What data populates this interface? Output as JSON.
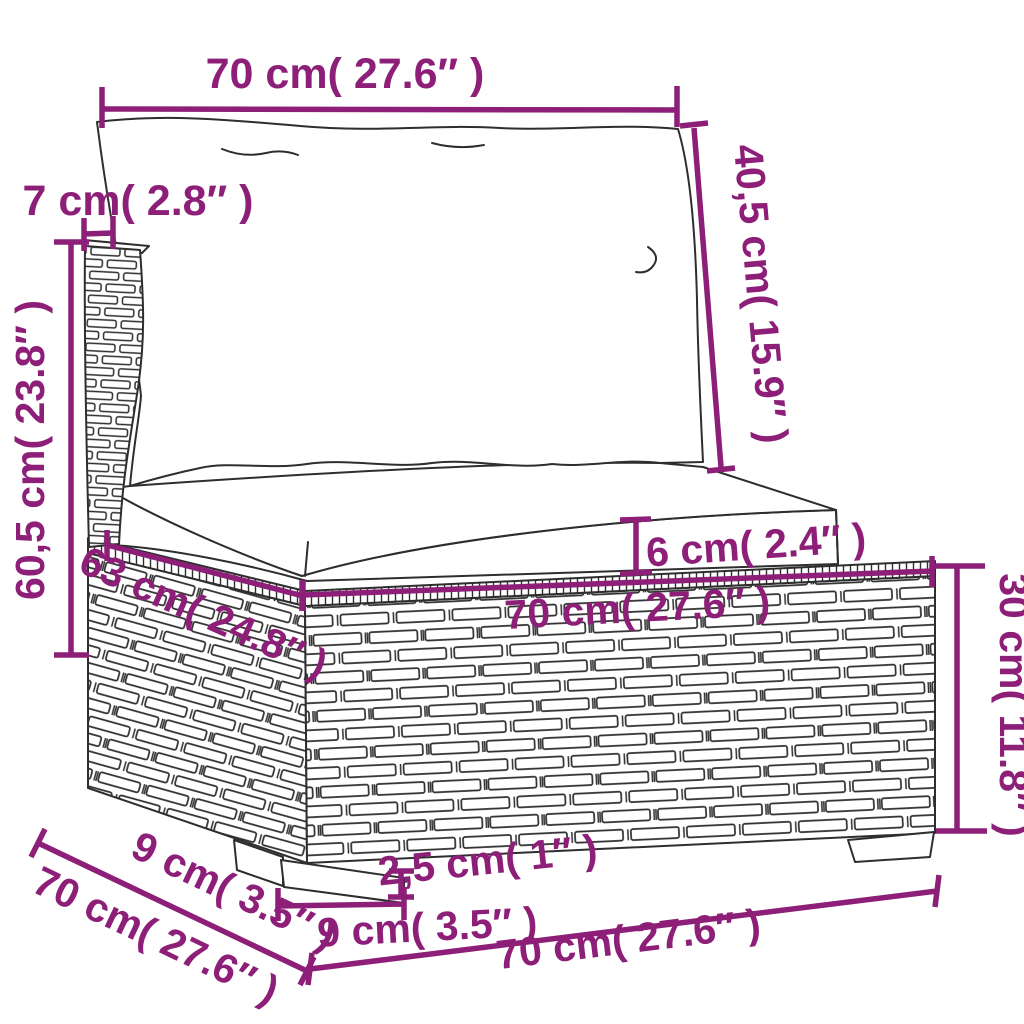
{
  "diagram": {
    "kind": "product-dimension-diagram",
    "subject": "poly-rattan-sofa-middle-section-with-cushions",
    "background_color": "#ffffff",
    "accent_color": "#8d1f78",
    "line_color": "#2e2e2e",
    "dimensions": [
      {
        "id": "top-width",
        "label": "70 cm( 27.6″ )"
      },
      {
        "id": "back-thickness",
        "label": "7 cm( 2.8″ )"
      },
      {
        "id": "back-height",
        "label": "40,5 cm( 15.9″ )"
      },
      {
        "id": "overall-height",
        "label": "60,5 cm( 23.8″ )"
      },
      {
        "id": "cushion-thickness",
        "label": "6 cm( 2.4″ )"
      },
      {
        "id": "seat-depth",
        "label": "63 cm( 24.8″ )"
      },
      {
        "id": "seat-width",
        "label": "70 cm( 27.6″ )"
      },
      {
        "id": "base-height",
        "label": "30 cm( 11.8″ )"
      },
      {
        "id": "leg-offset-depth",
        "label": "9 cm( 3.5″ )"
      },
      {
        "id": "overall-depth",
        "label": "70 cm( 27.6″ )"
      },
      {
        "id": "leg-height",
        "label": "2,5 cm( 1″ )"
      },
      {
        "id": "leg-width",
        "label": "9 cm( 3.5″ )"
      },
      {
        "id": "base-width",
        "label": "70 cm( 27.6″ )"
      }
    ]
  }
}
